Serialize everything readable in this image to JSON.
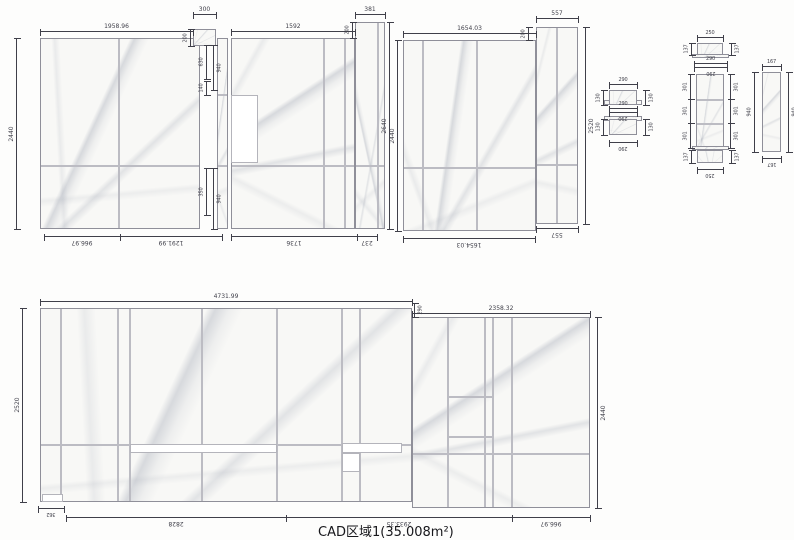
{
  "title": "CAD区域1(35.008m²)",
  "panel1": {
    "width_top": "1958.96",
    "notch_width": "300",
    "notch_height": "200",
    "height_left": "2440",
    "bottom_left": "966.97",
    "bottom_right": "1291.99",
    "gap_top_a": "630",
    "gap_top_b": "940",
    "gap_mid": "140",
    "gap_bot_a": "350",
    "gap_bot_b": "940"
  },
  "panel2": {
    "width_top": "1592",
    "strip_width": "381",
    "strip_height": "200",
    "height_outer": "2640",
    "bottom_left": "1736",
    "bottom_right": "237"
  },
  "panel3": {
    "height_left": "2440",
    "width_top": "1654.03",
    "strip_width": "557",
    "strip_height": "200",
    "height_right": "2520",
    "bottom_width": "1654.03",
    "bottom_strip": "557"
  },
  "bigpanel": {
    "width_left": "4731.99",
    "width_right": "2358.32",
    "step_height": "290",
    "height_left": "2520",
    "height_right": "2440",
    "notch_width": "362",
    "bottom_a": "2828",
    "bottom_b": "2933.35",
    "bottom_c": "966.97"
  },
  "detailA": {
    "width": "290",
    "height": "130"
  },
  "detailB": {
    "cap_width": "250",
    "cap_height": "137",
    "flange_width": "290",
    "segment_height": "301"
  },
  "detailC": {
    "width": "167",
    "height": "940"
  }
}
